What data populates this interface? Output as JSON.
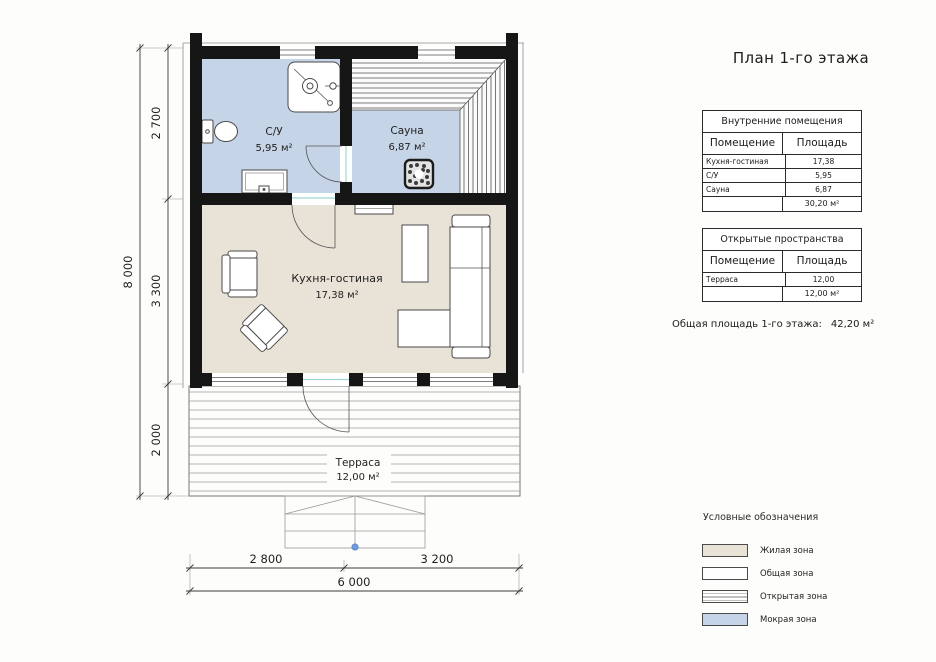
{
  "title": "План 1-го этажа",
  "plan": {
    "rooms": {
      "bathroom": {
        "name": "С/У",
        "area": "5,95 м²"
      },
      "sauna": {
        "name": "Сауна",
        "area": "6,87 м²"
      },
      "kitchen_living": {
        "name": "Кухня-гостиная",
        "area": "17,38 м²"
      },
      "terrace": {
        "name": "Терраса",
        "area": "12,00 м²"
      }
    },
    "dimensions": {
      "v_total": "8 000",
      "v_seg1": "2 700",
      "v_seg2": "3 300",
      "v_seg3": "2 000",
      "h_seg1": "2 800",
      "h_seg2": "3 200",
      "h_total": "6 000"
    }
  },
  "interior_table": {
    "title": "Внутренние помещения",
    "col_room": "Помещение",
    "col_area": "Площадь",
    "rows": [
      {
        "room": "Кухня-гостиная",
        "area": "17,38"
      },
      {
        "room": "С/У",
        "area": "5,95"
      },
      {
        "room": "Сауна",
        "area": "6,87"
      }
    ],
    "total": "30,20 м²"
  },
  "open_table": {
    "title": "Открытые пространства",
    "col_room": "Помещение",
    "col_area": "Площадь",
    "rows": [
      {
        "room": "Терраса",
        "area": "12,00"
      }
    ],
    "total": "12,00 м²"
  },
  "summary": {
    "label": "Общая площадь 1-го этажа:",
    "value": "42,20 м²"
  },
  "legend": {
    "title": "Условные обозначения",
    "items": [
      {
        "label": "Жилая зона"
      },
      {
        "label": "Общая зона"
      },
      {
        "label": "Открытая зона"
      },
      {
        "label": "Мокрая зона"
      }
    ]
  },
  "colors": {
    "wet_zone": "#c6d4e8",
    "living_zone": "#e8e2d7",
    "wall": "#161616",
    "door_accent": "#9ed8d0",
    "entry_dot": "#6f9ad9"
  }
}
